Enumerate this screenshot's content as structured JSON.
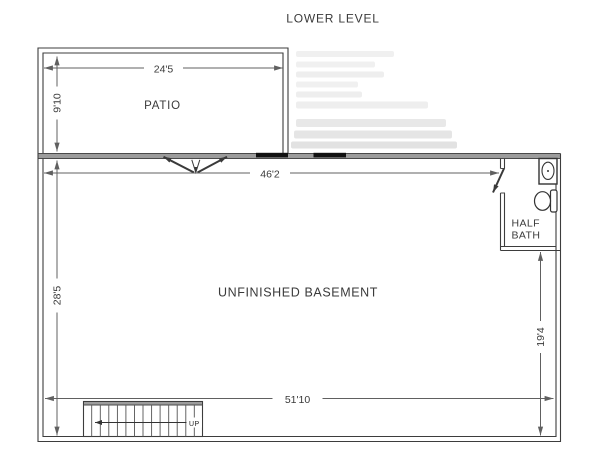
{
  "page": {
    "title": "LOWER LEVEL"
  },
  "rooms": {
    "patio": {
      "name": "PATIO"
    },
    "basement": {
      "name": "UNFINISHED BASEMENT"
    },
    "half_bath": {
      "name_line1": "HALF",
      "name_line2": "BATH"
    }
  },
  "dimensions": {
    "patio_width": "24'5",
    "patio_depth": "9'10",
    "basement_width_top": "46'2",
    "basement_depth_left": "28'5",
    "basement_depth_right": "19'4",
    "basement_width_bottom": "51'10"
  },
  "stairs": {
    "direction": "UP"
  },
  "icons": {
    "sink": "sink-icon",
    "toilet": "toilet-icon",
    "double_door": "double-door-icon",
    "door_swing": "door-swing-icon",
    "up_arrow": "up-arrow-icon"
  },
  "colors": {
    "background": "#ffffff",
    "wall_line": "#3d3d3d",
    "wall_band": "#9c9c9c",
    "dimension_line": "#606060",
    "text": "#3a3a3a",
    "window_fill": "#111111"
  }
}
